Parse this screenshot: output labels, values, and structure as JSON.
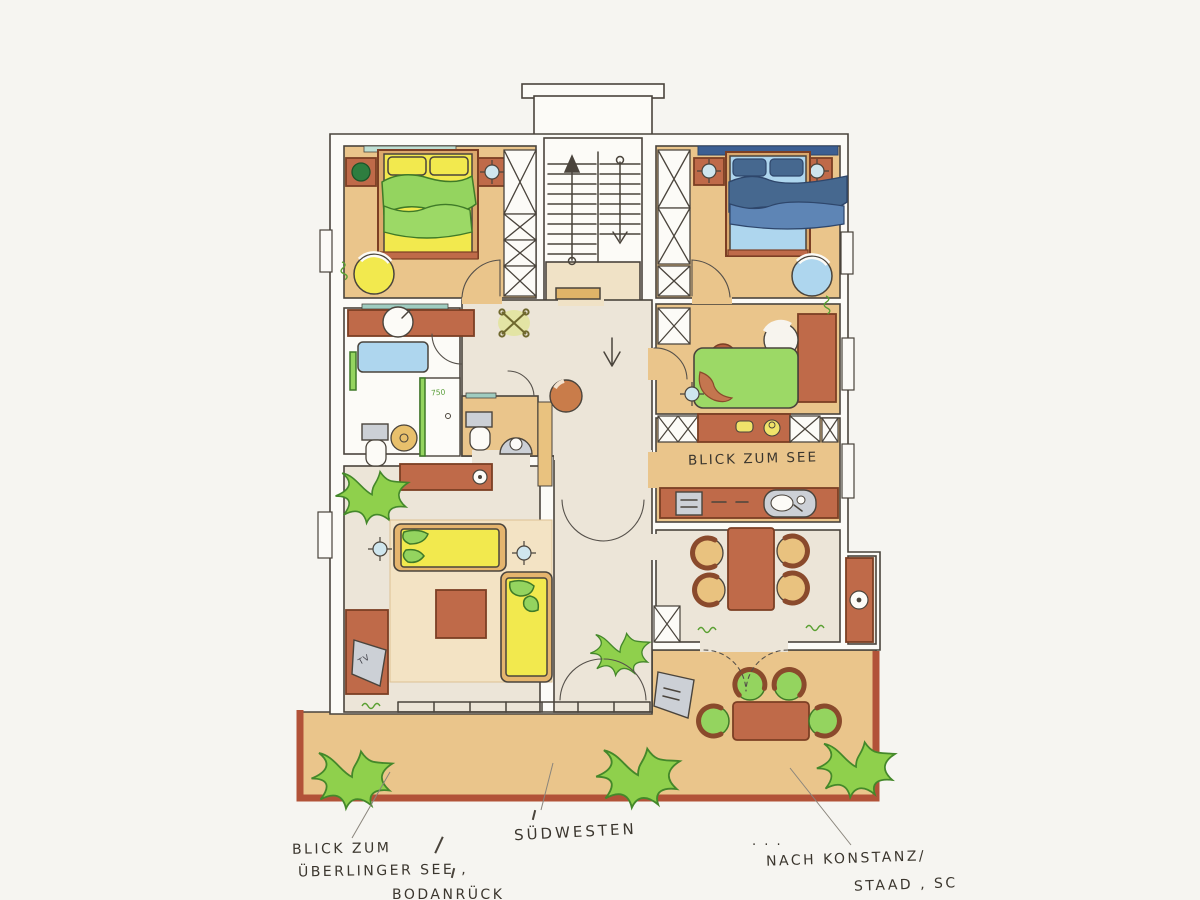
{
  "annotations": {
    "kitchen_view": "BLICK ZUM SEE",
    "compass_south": "SÜDWESTEN",
    "view_left": [
      "BLICK ZUM",
      "ÜBERLINGER SEE ,",
      "BODANRÜCK"
    ],
    "view_right_dots": ". . .",
    "view_right": [
      "NACH KONSTANZ/",
      "STAAD , SC"
    ],
    "tv_label": "TV",
    "shower_label": "750"
  },
  "palette": {
    "paper": "#f6f5f1",
    "floor_tan": "#eac58b",
    "floor_cream": "#ece5d8",
    "terracotta": "#bf6a49",
    "accent_yellow": "#f2e94e",
    "accent_green": "#94d45f",
    "accent_blue": "#aed6ee",
    "ink": "#4a443c",
    "balcony_border": "#b25238"
  }
}
